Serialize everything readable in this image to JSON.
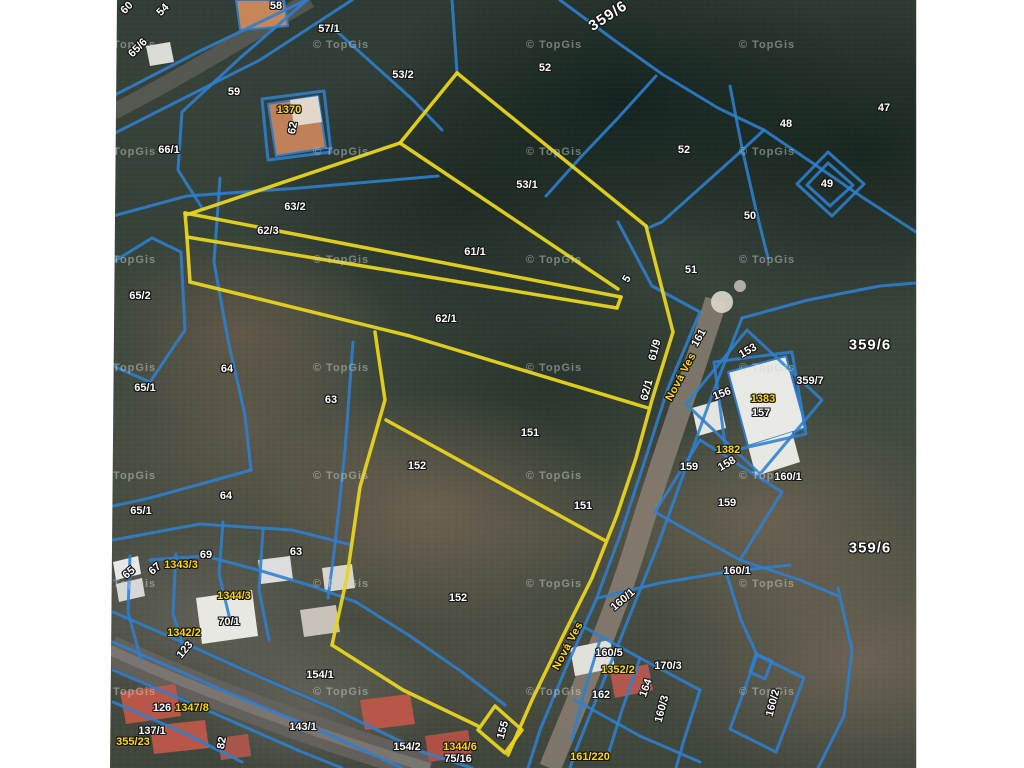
{
  "map": {
    "attribution": "© TopGis",
    "colors": {
      "parcel_line": "#2e7fd0",
      "highlight_line": "#e8d41f",
      "label_white": "#ffffff",
      "label_yellow": "#ffd900"
    },
    "street_names": [
      "Nová Ves"
    ],
    "labels": [
      {
        "text": "60",
        "x": 127,
        "y": 8,
        "rot": -45
      },
      {
        "text": "54",
        "x": 163,
        "y": 10,
        "rot": -45
      },
      {
        "text": "65/6",
        "x": 138,
        "y": 48,
        "rot": -45
      },
      {
        "text": "58",
        "x": 276,
        "y": 6
      },
      {
        "text": "57/1",
        "x": 329,
        "y": 29
      },
      {
        "text": "53/2",
        "x": 403,
        "y": 75
      },
      {
        "text": "52",
        "x": 545,
        "y": 68
      },
      {
        "text": "359/6",
        "x": 608,
        "y": 16,
        "rot": -33,
        "kind": "big"
      },
      {
        "text": "59",
        "x": 234,
        "y": 92
      },
      {
        "text": "1370",
        "x": 289,
        "y": 110,
        "kind": "hl"
      },
      {
        "text": "62",
        "x": 293,
        "y": 128,
        "rot": -80
      },
      {
        "text": "66/1",
        "x": 169,
        "y": 150
      },
      {
        "text": "47",
        "x": 884,
        "y": 108
      },
      {
        "text": "48",
        "x": 786,
        "y": 124
      },
      {
        "text": "52",
        "x": 684,
        "y": 150
      },
      {
        "text": "49",
        "x": 827,
        "y": 184
      },
      {
        "text": "50",
        "x": 750,
        "y": 216
      },
      {
        "text": "53/1",
        "x": 527,
        "y": 185
      },
      {
        "text": "63/2",
        "x": 295,
        "y": 207
      },
      {
        "text": "62/3",
        "x": 268,
        "y": 231
      },
      {
        "text": "61/1",
        "x": 475,
        "y": 252
      },
      {
        "text": "51",
        "x": 691,
        "y": 270
      },
      {
        "text": "5",
        "x": 627,
        "y": 279,
        "rot": -60
      },
      {
        "text": "65/2",
        "x": 140,
        "y": 296
      },
      {
        "text": "62/1",
        "x": 446,
        "y": 319
      },
      {
        "text": "61/9",
        "x": 655,
        "y": 350,
        "rot": -75
      },
      {
        "text": "161",
        "x": 699,
        "y": 338,
        "rot": -60
      },
      {
        "text": "153",
        "x": 748,
        "y": 351,
        "rot": -30
      },
      {
        "text": "359/6",
        "x": 870,
        "y": 345,
        "kind": "big"
      },
      {
        "text": "359/7",
        "x": 810,
        "y": 381
      },
      {
        "text": "64",
        "x": 227,
        "y": 369
      },
      {
        "text": "65/1",
        "x": 145,
        "y": 388
      },
      {
        "text": "Nová Ves",
        "x": 681,
        "y": 377,
        "rot": -62,
        "kind": "street"
      },
      {
        "text": "62/1",
        "x": 647,
        "y": 390,
        "rot": -75
      },
      {
        "text": "156",
        "x": 722,
        "y": 394,
        "rot": -20
      },
      {
        "text": "1383",
        "x": 763,
        "y": 399,
        "kind": "hl"
      },
      {
        "text": "63",
        "x": 331,
        "y": 400
      },
      {
        "text": "157",
        "x": 761,
        "y": 413
      },
      {
        "text": "151",
        "x": 530,
        "y": 433
      },
      {
        "text": "1382",
        "x": 728,
        "y": 450,
        "kind": "hl"
      },
      {
        "text": "158",
        "x": 727,
        "y": 464,
        "rot": -30
      },
      {
        "text": "152",
        "x": 417,
        "y": 466
      },
      {
        "text": "159",
        "x": 689,
        "y": 467
      },
      {
        "text": "160/1",
        "x": 788,
        "y": 477
      },
      {
        "text": "64",
        "x": 226,
        "y": 496
      },
      {
        "text": "159",
        "x": 727,
        "y": 503
      },
      {
        "text": "151",
        "x": 583,
        "y": 506
      },
      {
        "text": "65/1",
        "x": 141,
        "y": 511
      },
      {
        "text": "359/6",
        "x": 870,
        "y": 548,
        "kind": "big"
      },
      {
        "text": "63",
        "x": 296,
        "y": 552
      },
      {
        "text": "69",
        "x": 206,
        "y": 555
      },
      {
        "text": "67",
        "x": 155,
        "y": 569,
        "rot": -40
      },
      {
        "text": "65",
        "x": 129,
        "y": 573,
        "rot": -40
      },
      {
        "text": "1343/3",
        "x": 181,
        "y": 565,
        "kind": "hl"
      },
      {
        "text": "160/1",
        "x": 737,
        "y": 571
      },
      {
        "text": "1344/3",
        "x": 234,
        "y": 596,
        "kind": "hl"
      },
      {
        "text": "152",
        "x": 458,
        "y": 598
      },
      {
        "text": "160/1",
        "x": 623,
        "y": 600,
        "rot": -40
      },
      {
        "text": "70/1",
        "x": 229,
        "y": 622
      },
      {
        "text": "1342/2",
        "x": 184,
        "y": 633,
        "kind": "hl"
      },
      {
        "text": "Nová Ves",
        "x": 568,
        "y": 646,
        "rot": -62,
        "kind": "street"
      },
      {
        "text": "123",
        "x": 185,
        "y": 650,
        "rot": -50
      },
      {
        "text": "160/5",
        "x": 609,
        "y": 653
      },
      {
        "text": "1352/2",
        "x": 618,
        "y": 670,
        "kind": "hl"
      },
      {
        "text": "170/3",
        "x": 668,
        "y": 666
      },
      {
        "text": "154/1",
        "x": 320,
        "y": 675
      },
      {
        "text": "164",
        "x": 646,
        "y": 688,
        "rot": -70
      },
      {
        "text": "162",
        "x": 601,
        "y": 695
      },
      {
        "text": "160/2",
        "x": 773,
        "y": 703,
        "rot": -75
      },
      {
        "text": "126",
        "x": 162,
        "y": 708
      },
      {
        "text": "1347/8",
        "x": 192,
        "y": 708,
        "kind": "hl"
      },
      {
        "text": "160/3",
        "x": 662,
        "y": 709,
        "rot": -75
      },
      {
        "text": "143/1",
        "x": 303,
        "y": 727
      },
      {
        "text": "155",
        "x": 503,
        "y": 730,
        "rot": -75
      },
      {
        "text": "137/1",
        "x": 152,
        "y": 731
      },
      {
        "text": "355/23",
        "x": 133,
        "y": 742,
        "kind": "hl"
      },
      {
        "text": "82",
        "x": 222,
        "y": 743,
        "rot": -80
      },
      {
        "text": "154/2",
        "x": 407,
        "y": 747
      },
      {
        "text": "1344/6",
        "x": 460,
        "y": 747,
        "kind": "hl"
      },
      {
        "text": "75/16",
        "x": 458,
        "y": 759
      },
      {
        "text": "161/220",
        "x": 590,
        "y": 757,
        "kind": "hl"
      }
    ],
    "watermarks": [
      {
        "x": 128,
        "y": 45
      },
      {
        "x": 341,
        "y": 45
      },
      {
        "x": 554,
        "y": 45
      },
      {
        "x": 767,
        "y": 45
      },
      {
        "x": 128,
        "y": 152
      },
      {
        "x": 341,
        "y": 152
      },
      {
        "x": 554,
        "y": 152
      },
      {
        "x": 767,
        "y": 152
      },
      {
        "x": 128,
        "y": 260
      },
      {
        "x": 341,
        "y": 260
      },
      {
        "x": 554,
        "y": 260
      },
      {
        "x": 767,
        "y": 260
      },
      {
        "x": 128,
        "y": 368
      },
      {
        "x": 341,
        "y": 368
      },
      {
        "x": 554,
        "y": 368
      },
      {
        "x": 767,
        "y": 368
      },
      {
        "x": 128,
        "y": 476
      },
      {
        "x": 341,
        "y": 476
      },
      {
        "x": 554,
        "y": 476
      },
      {
        "x": 767,
        "y": 476
      },
      {
        "x": 128,
        "y": 584
      },
      {
        "x": 341,
        "y": 584
      },
      {
        "x": 554,
        "y": 584
      },
      {
        "x": 767,
        "y": 584
      },
      {
        "x": 128,
        "y": 692
      },
      {
        "x": 341,
        "y": 692
      },
      {
        "x": 554,
        "y": 692
      },
      {
        "x": 767,
        "y": 692
      }
    ]
  }
}
